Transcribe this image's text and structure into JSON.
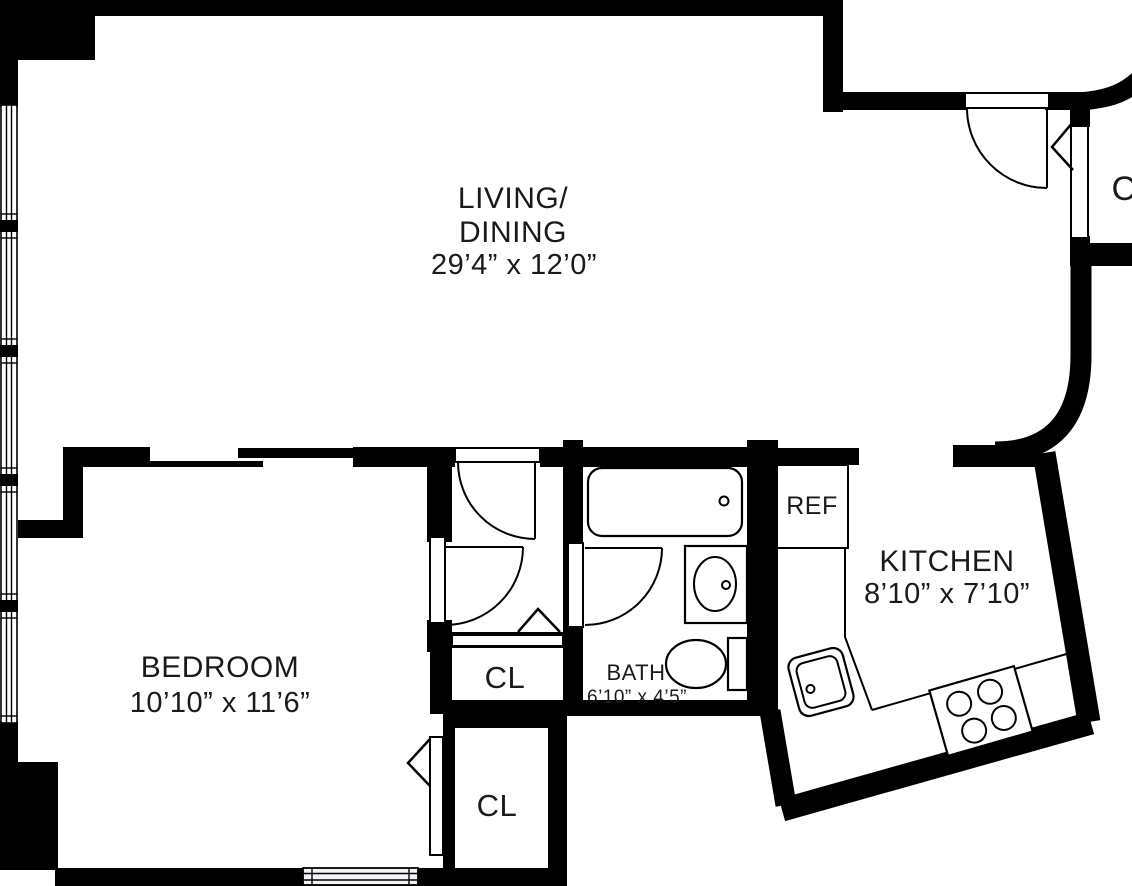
{
  "title": "One-bedroom apartment floor plan",
  "labels": {
    "living_line1": "LIVING/",
    "living_line2": "DINING",
    "living_dims": "29’4” x 12’0”",
    "bedroom": "BEDROOM",
    "bedroom_dims": "10’10” x 11’6”",
    "kitchen": "KITCHEN",
    "kitchen_dims": "8’10” x 7’10”",
    "bath": "BATH",
    "bath_dims": "6’10” x 4’5”",
    "refrigerator": "REF",
    "closet_hall": "CL",
    "closet_bedroom": "CL",
    "closet_entry": "C"
  },
  "colors": {
    "walls": "#000000",
    "background": "#ffffff",
    "text": "#1a1a1a"
  }
}
